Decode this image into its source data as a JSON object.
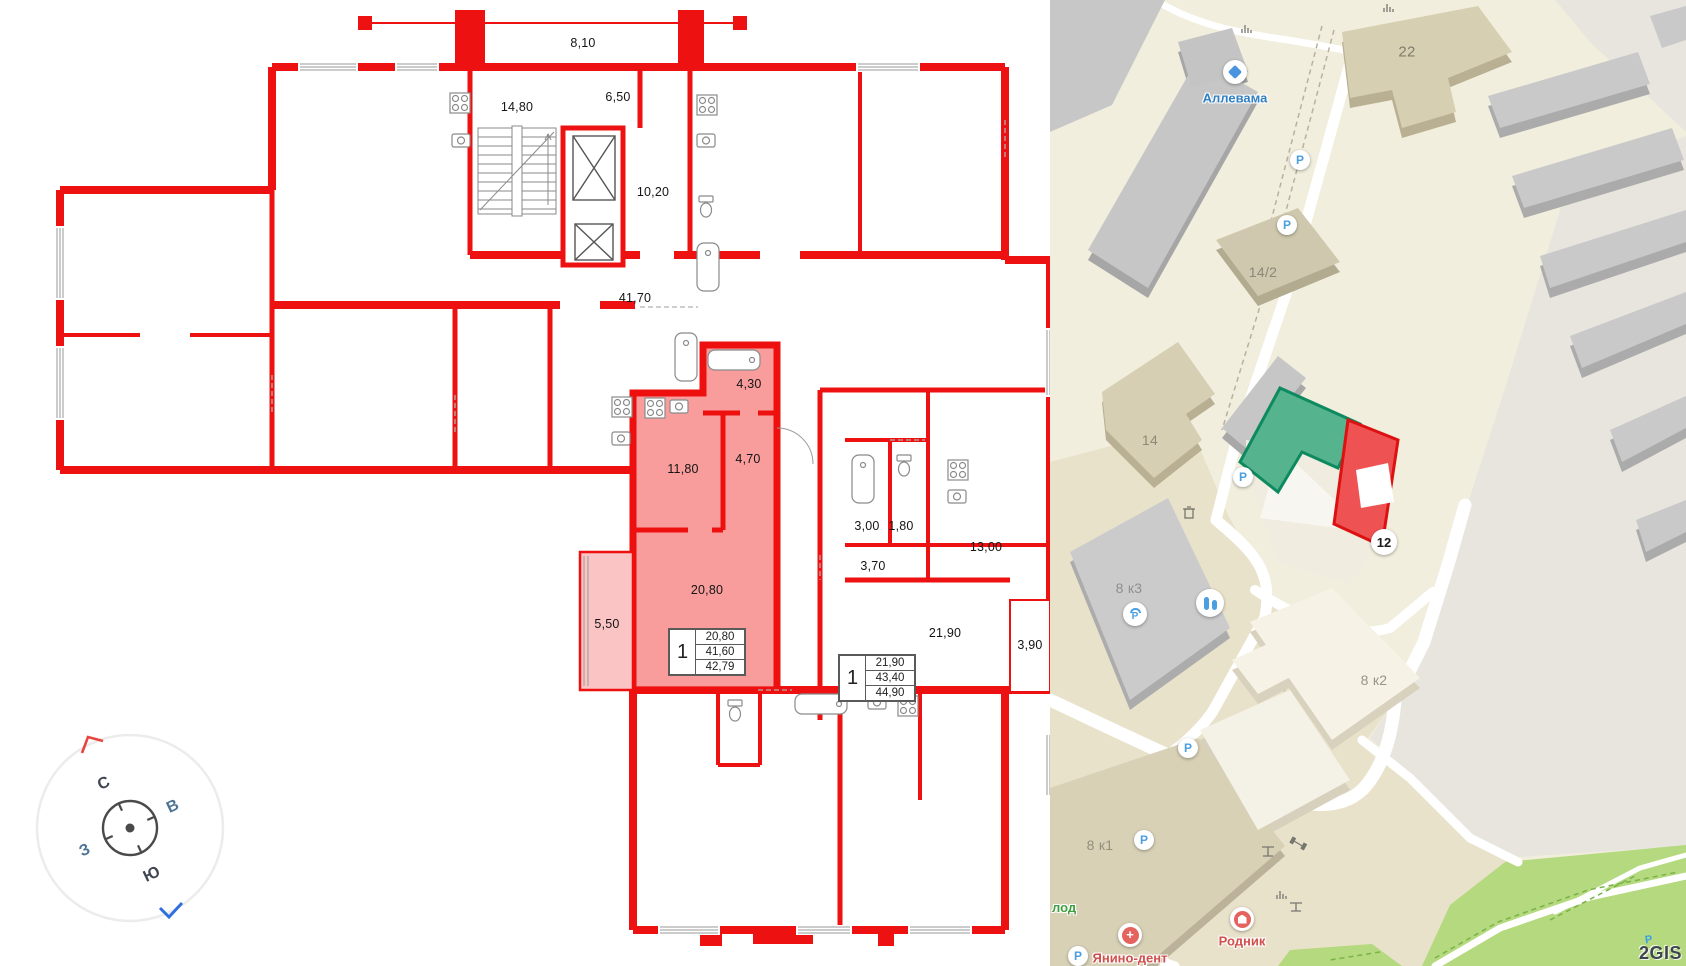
{
  "floorplan": {
    "dimension_labels": [
      "8,10",
      "14,80",
      "6,50",
      "10,20",
      "41,70",
      "4,30",
      "4,70",
      "11,80",
      "20,80",
      "5,50",
      "3,00",
      "1,80",
      "13,00",
      "3,70",
      "21,90",
      "3,90"
    ],
    "unit_tables": [
      {
        "rooms": "1",
        "living_area": "20,80",
        "area": "41,60",
        "total_area": "42,79"
      },
      {
        "rooms": "1",
        "living_area": "21,90",
        "area": "43,40",
        "total_area": "44,90"
      }
    ],
    "compass": {
      "north": "С",
      "east": "В",
      "west": "З",
      "south": "Ю"
    }
  },
  "map": {
    "poi_labels": {
      "allevama": "Аллевама",
      "yanino_dent": "Янино-дент",
      "rodnik": "Родник",
      "clipped_green_label": "лод"
    },
    "building_labels": {
      "b22": "22",
      "b14_2": "14/2",
      "b14": "14",
      "b8k3": "8 к3",
      "b8k2": "8 к2",
      "b8k1": "8 к1"
    },
    "selected_building_badge": "12",
    "parking_label": "P",
    "logo": "2GIS"
  },
  "colors": {
    "plan_wall": "#ee1111",
    "highlight_fill": "#f78b8b",
    "map_green_building": "#55b38e",
    "map_red_building": "#ef5252",
    "map_park": "#b5d97e",
    "poi_blue": "#2f7fc1",
    "poi_red": "#cf4f4c"
  }
}
